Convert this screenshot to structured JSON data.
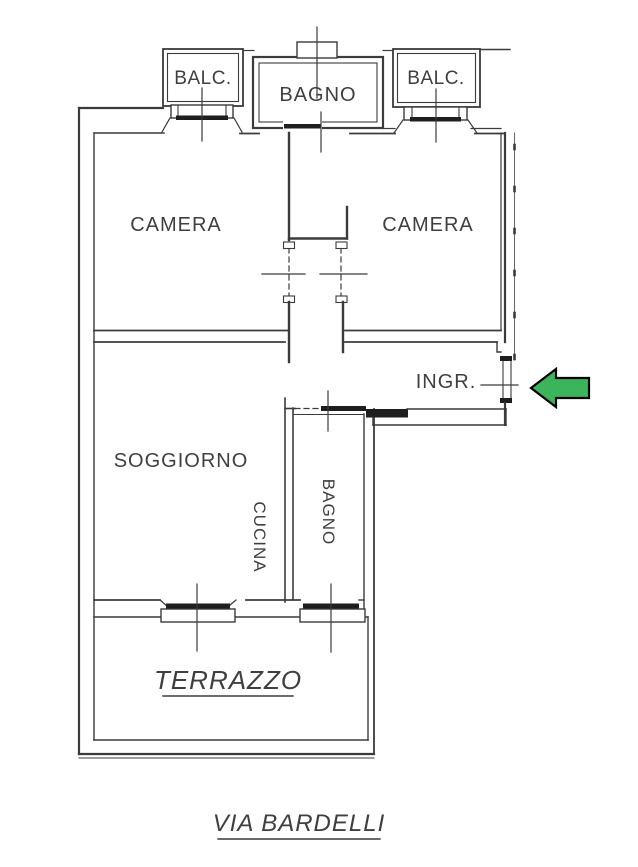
{
  "plan": {
    "rooms": {
      "balc_left": "BALC.",
      "balc_right": "BALC.",
      "bagno_top": "BAGNO",
      "camera_left": "CAMERA",
      "camera_right": "CAMERA",
      "ingresso": "INGR.",
      "soggiorno": "SOGGIORNO",
      "cucina": "CUCINA",
      "bagno_lower": "BAGNO",
      "terrazzo": "TERRAZZO"
    },
    "street": "VIA BARDELLI",
    "colors": {
      "wall": "#3b3b3b",
      "label": "#3f3f3f",
      "arrow_fill": "#3cb45c",
      "arrow_outline": "#000000",
      "background": "#ffffff"
    },
    "entrance_arrow_direction": "left"
  }
}
